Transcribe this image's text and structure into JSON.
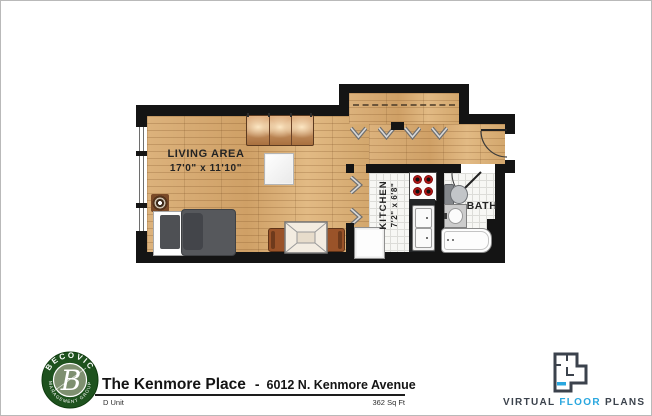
{
  "plan": {
    "living": {
      "label": "LIVING AREA",
      "dims": "17'0\" x 11'10\""
    },
    "kitchen": {
      "label": "KITCHEN",
      "dims": "7'2\" x 6'8\""
    },
    "bath": {
      "label": "BATH"
    }
  },
  "footer": {
    "logo": {
      "arc_top": "BECOVIC",
      "arc_bottom": "MANAGEMENT GROUP",
      "monogram": "B"
    },
    "title": "The Kenmore Place",
    "separator": "-",
    "address": "6012 N. Kenmore Avenue",
    "unit": "D Unit",
    "area": "362 Sq Ft",
    "vfp": {
      "word1": "VIRTUAL",
      "word2": "FLOOR",
      "word3": "PLANS"
    }
  },
  "colors": {
    "wall": "#141414",
    "wood_floor": "#d4a76f",
    "tile_floor": "#f7f7f4",
    "brand_green": "#1e521e",
    "vfp_blue": "#2aa7df",
    "burner_red": "#b31515"
  }
}
